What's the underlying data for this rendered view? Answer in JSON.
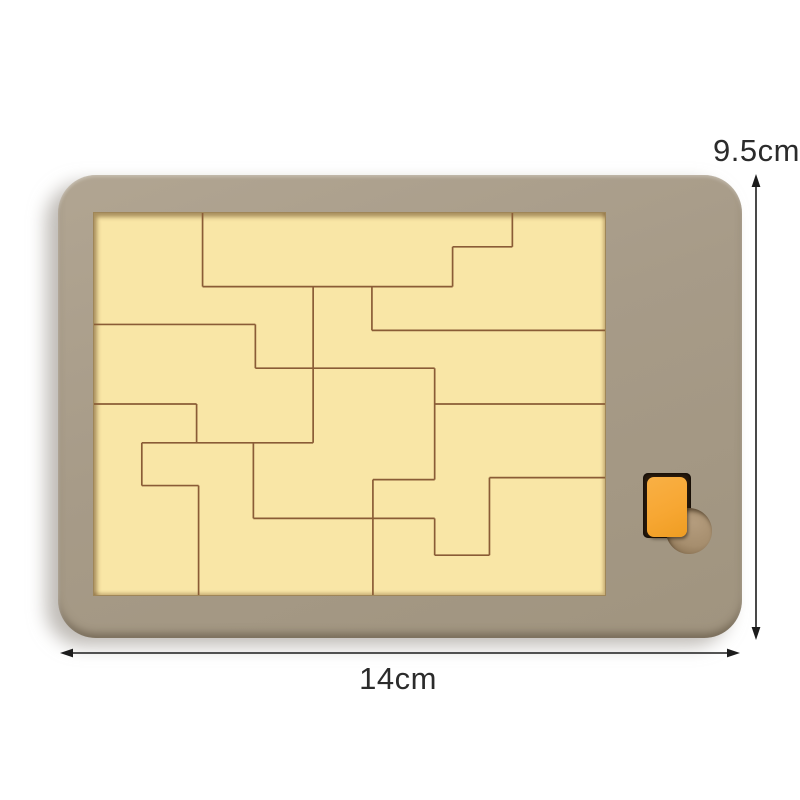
{
  "product": {
    "name": "wooden-puzzle-board",
    "board_color": "#a79b88",
    "board_edge_color": "#8c8070",
    "recess_color": "#f9e6a6",
    "outline_color": "#8a5c36",
    "slot_color": "#2b1c0e",
    "piece_color": "#f7a733",
    "finger_hole_color": "#b49c7d",
    "finger_hole_shadow_color": "#7d6546"
  },
  "dimensions": {
    "height_label": "9.5cm",
    "width_label": "14cm",
    "arrow_color": "#1c1c1c",
    "text_color": "#2b2b2b"
  },
  "puzzle": {
    "viewbox": "0 0 513 384",
    "line_width": 1.7,
    "segments": [
      [
        109,
        0,
        109,
        74
      ],
      [
        109,
        74,
        360,
        74
      ],
      [
        420,
        0,
        420,
        34
      ],
      [
        360,
        34,
        420,
        34
      ],
      [
        360,
        34,
        360,
        74
      ],
      [
        279,
        74,
        279,
        118
      ],
      [
        279,
        118,
        513,
        118
      ],
      [
        0,
        112,
        162,
        112
      ],
      [
        162,
        112,
        162,
        156
      ],
      [
        162,
        156,
        342,
        156
      ],
      [
        342,
        156,
        342,
        268
      ],
      [
        342,
        192,
        513,
        192
      ],
      [
        220,
        74,
        220,
        231
      ],
      [
        48,
        231,
        220,
        231
      ],
      [
        48,
        231,
        48,
        274
      ],
      [
        48,
        274,
        105,
        274
      ],
      [
        105,
        274,
        105,
        384
      ],
      [
        0,
        192,
        103,
        192
      ],
      [
        103,
        192,
        103,
        231
      ],
      [
        160,
        231,
        160,
        307
      ],
      [
        160,
        307,
        342,
        307
      ],
      [
        342,
        307,
        342,
        344
      ],
      [
        342,
        344,
        397,
        344
      ],
      [
        397,
        266,
        397,
        344
      ],
      [
        397,
        266,
        513,
        266
      ],
      [
        280,
        268,
        342,
        268
      ],
      [
        280,
        268,
        280,
        384
      ]
    ]
  }
}
